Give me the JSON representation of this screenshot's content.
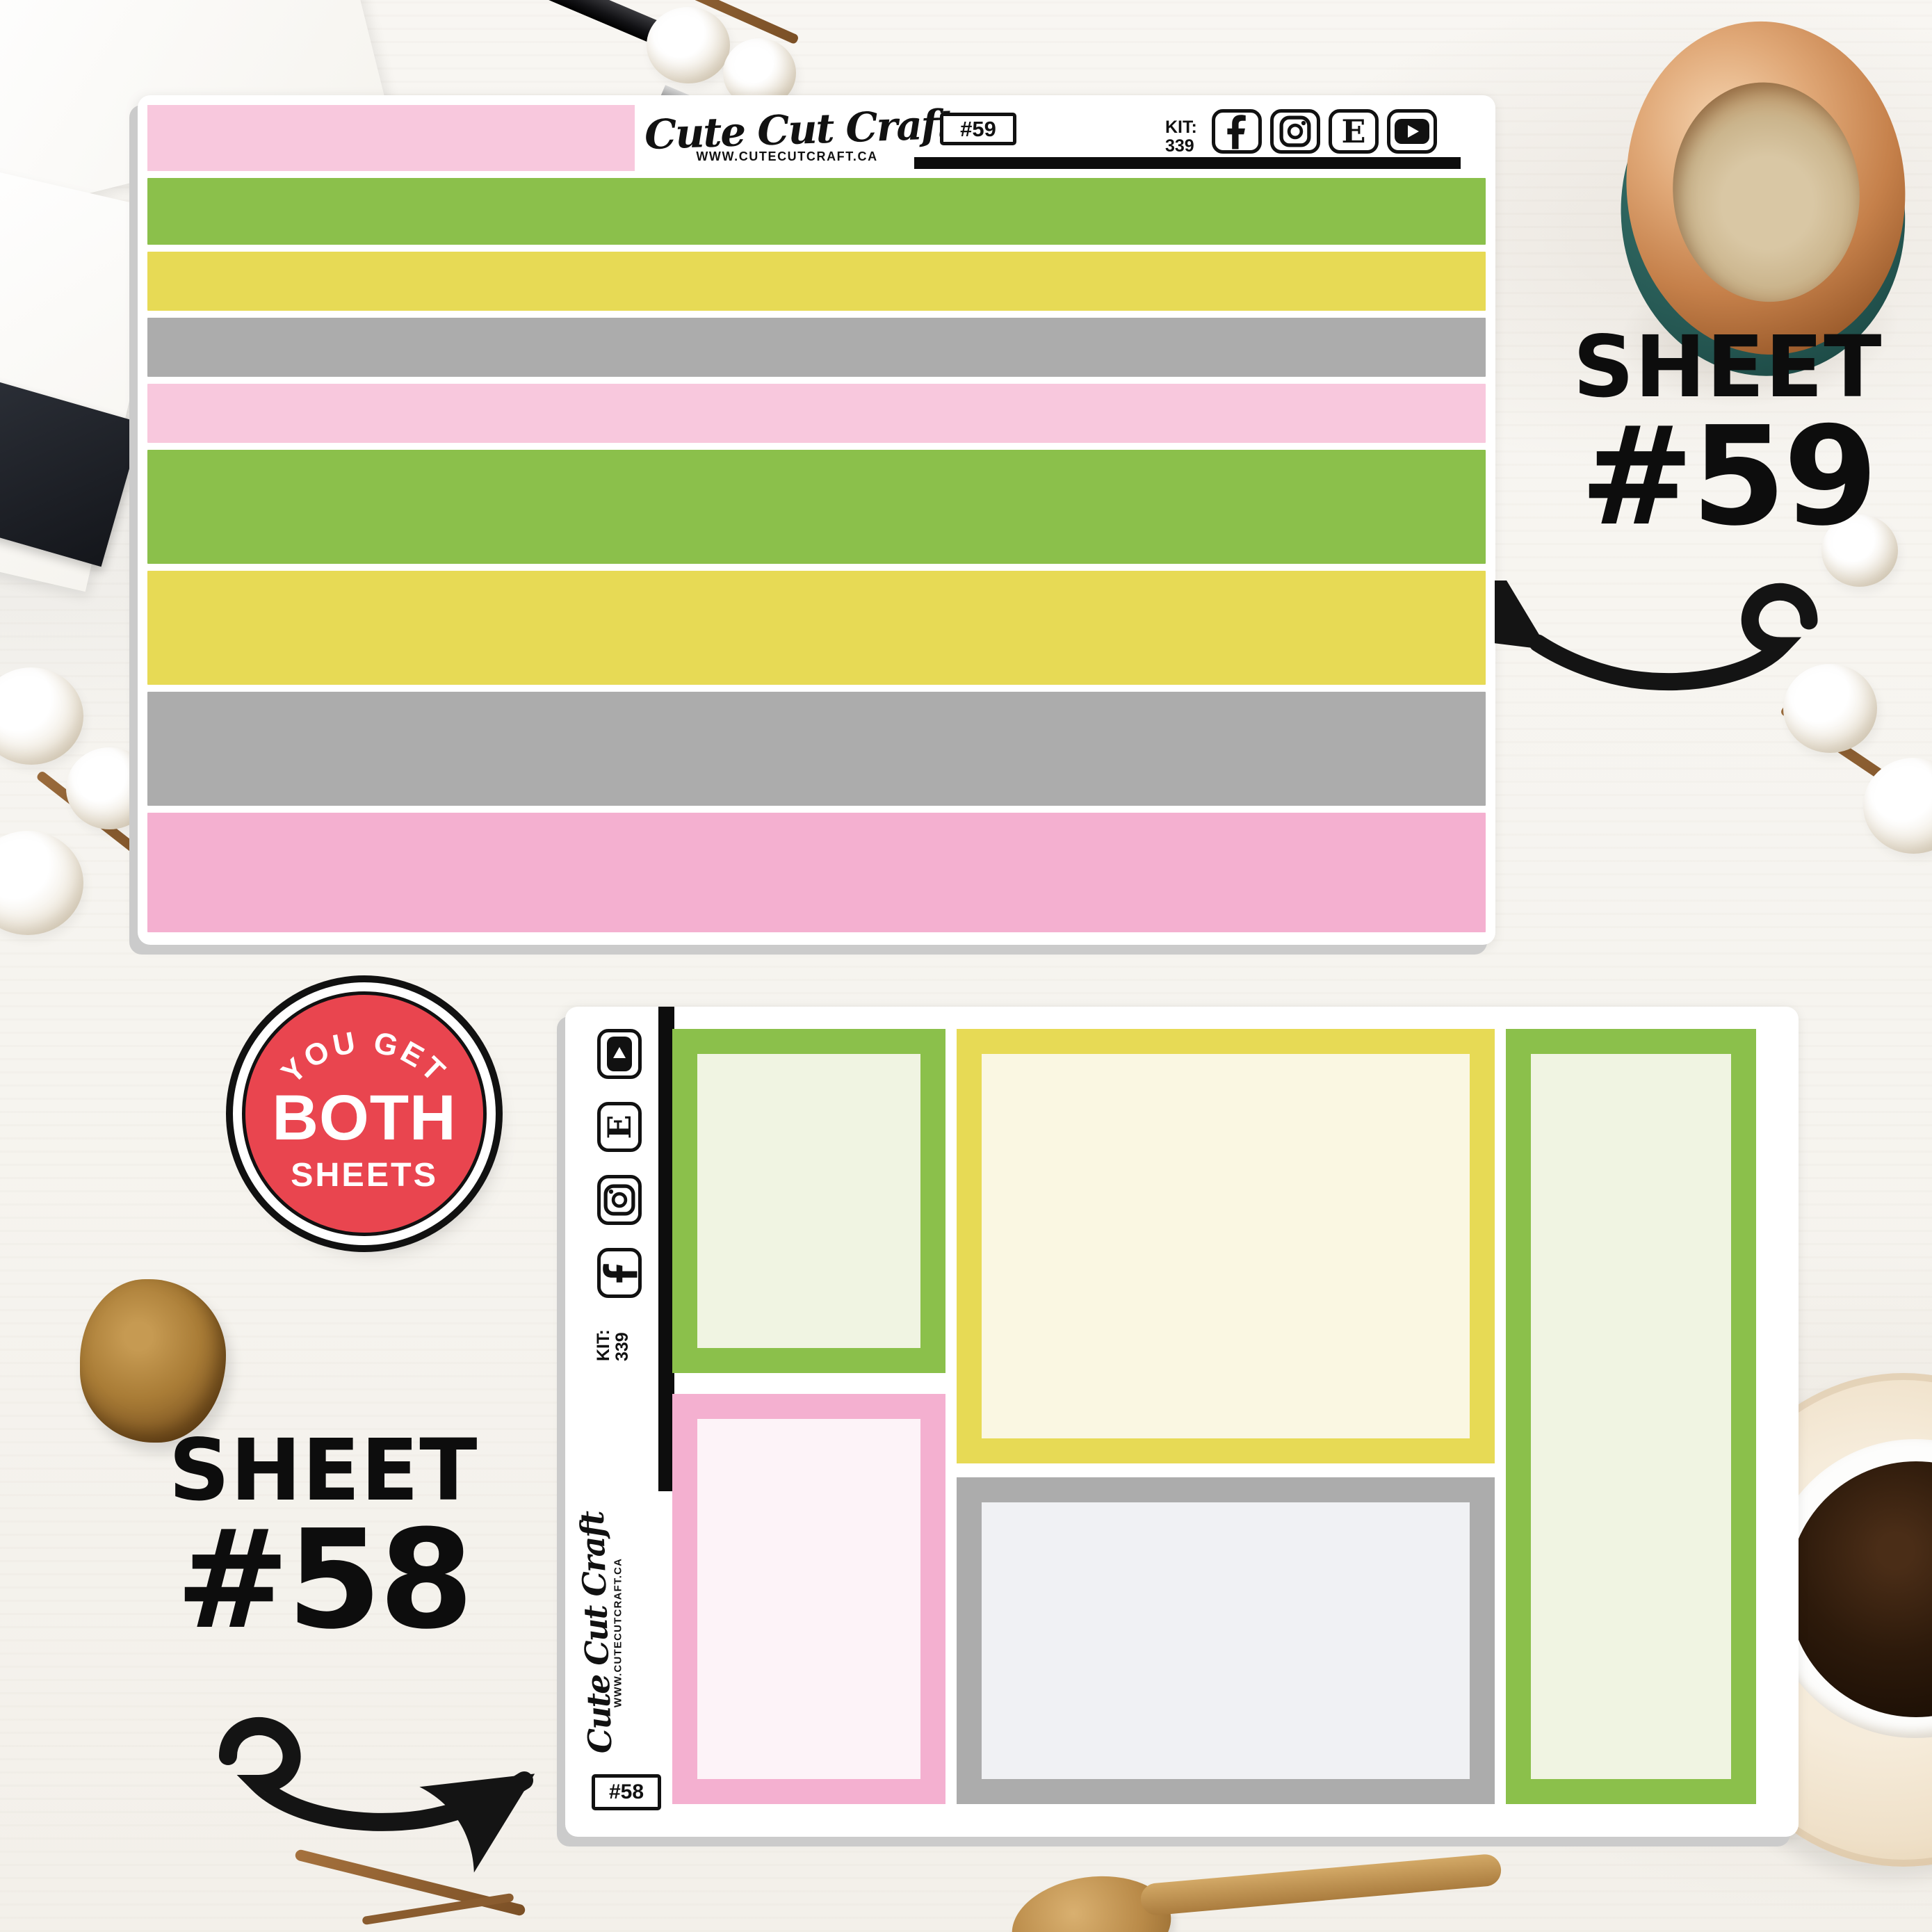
{
  "palette": {
    "green": "#8bc04b",
    "yellow": "#e7da55",
    "gray": "#acacac",
    "pink_light": "#f8c8dd",
    "pink": "#f4b0d0",
    "fill_green": "#f0f4e2",
    "fill_cream": "#faf7e2",
    "fill_pink": "#fdf3f8",
    "fill_gray": "#f0f1f4",
    "badge_red": "#e9454f",
    "black": "#111111"
  },
  "brand": {
    "logo": "Cute Cut Craft",
    "website": "WWW.CUTECUTCRAFT.CA",
    "kit_label": "KIT:",
    "kit_number": "339",
    "facebook_letter": "f",
    "etsy_letter": "E"
  },
  "social_icons": [
    "facebook-icon",
    "instagram-icon",
    "etsy-icon",
    "youtube-icon"
  ],
  "sheet59": {
    "tag": "#59",
    "strips": [
      {
        "color": "pink_light",
        "size": "header"
      },
      {
        "color": "green",
        "size": "md"
      },
      {
        "color": "yellow",
        "size": "sm"
      },
      {
        "color": "gray",
        "size": "sm"
      },
      {
        "color": "pink_light",
        "size": "sm"
      },
      {
        "color": "green",
        "size": "lg"
      },
      {
        "color": "yellow",
        "size": "lg"
      },
      {
        "color": "gray",
        "size": "lg"
      },
      {
        "color": "pink",
        "size": "xl"
      }
    ]
  },
  "sheet58": {
    "tag": "#58",
    "boxes": [
      {
        "id": "top-left",
        "border": "green",
        "fill": "fill_green"
      },
      {
        "id": "bottom-left",
        "border": "pink",
        "fill": "fill_pink"
      },
      {
        "id": "top-mid",
        "border": "yellow",
        "fill": "fill_cream"
      },
      {
        "id": "bottom-mid",
        "border": "gray",
        "fill": "fill_gray"
      },
      {
        "id": "right",
        "border": "green",
        "fill": "fill_green"
      }
    ]
  },
  "badge": {
    "top": "YOU GET",
    "middle": "BOTH",
    "bottom": "SHEETS"
  },
  "callout_59": {
    "line1": "SHEET",
    "line2": "#59"
  },
  "callout_58": {
    "line1": "SHEET",
    "line2": "#58"
  }
}
